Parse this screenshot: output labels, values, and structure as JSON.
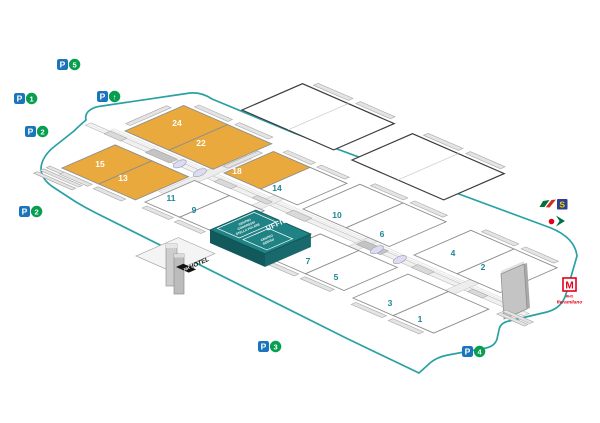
{
  "colors": {
    "boundary": "#2aa0a5",
    "hall_highlight": "#e9a93c",
    "hall_fill": "#ffffff",
    "hall_stroke": "#8f8f8f",
    "outlined_hall_stroke": "#3c3c3c",
    "hall_number": "#1e8795",
    "hall_number_highlight": "#ffffff",
    "offices_fill": "#1f8285",
    "offices_side_dark": "#11595b",
    "offices_side_mid": "#19696c",
    "parking_blue": "#1b75bc",
    "parking_green": "#069e4f",
    "metro_red": "#e2001a",
    "s_line_blue": "#2a3f90",
    "s_line_yellow": "#ffd200",
    "fs_green": "#00703c",
    "fs_red": "#d52b1e",
    "trenord_green": "#00704a",
    "ramp_fill": "#e4e4e4",
    "axis_fill": "#f0f0f0"
  },
  "halls": {
    "pairs": [
      {
        "id": "24-22",
        "labels": [
          "24",
          "22"
        ],
        "highlighted": [
          true,
          true
        ]
      },
      {
        "id": "18-14",
        "labels": [
          "18",
          "14"
        ],
        "highlighted": [
          true,
          false
        ]
      },
      {
        "id": "10-6",
        "labels": [
          "10",
          "6"
        ],
        "highlighted": [
          false,
          false
        ]
      },
      {
        "id": "4-2",
        "labels": [
          "4",
          "2"
        ],
        "highlighted": [
          false,
          false
        ]
      },
      {
        "id": "15-13",
        "labels": [
          "15",
          "13"
        ],
        "highlighted": [
          true,
          true
        ]
      },
      {
        "id": "11-9",
        "labels": [
          "11",
          "9"
        ],
        "highlighted": [
          false,
          false
        ]
      },
      {
        "id": "7-5",
        "labels": [
          "7",
          "5"
        ],
        "highlighted": [
          false,
          false
        ]
      },
      {
        "id": "3-1",
        "labels": [
          "3",
          "1"
        ],
        "highlighted": [
          false,
          false
        ]
      }
    ],
    "outlined_unlabeled_count": 2
  },
  "offices": {
    "title": "UFFICI",
    "congress_center": [
      "CENTRO",
      "CONGRESSI",
      "STELLA POLARE"
    ],
    "services_center": [
      "CENTRO",
      "SERVIZI"
    ]
  },
  "hotel": {
    "label": "HOTEL",
    "brand": "NH"
  },
  "metro": {
    "symbol": "M",
    "station_line1": "RHO",
    "station_line2": "fieramilano"
  },
  "rail": {
    "s_badge": "S"
  },
  "parking": [
    {
      "id": "p5",
      "letter": "P",
      "value": "5"
    },
    {
      "id": "p1",
      "letter": "P",
      "value": "1"
    },
    {
      "id": "p-multi",
      "letter": "P",
      "value": "↑"
    },
    {
      "id": "p2-west",
      "letter": "P",
      "value": "2"
    },
    {
      "id": "p2-south",
      "letter": "P",
      "value": "2"
    },
    {
      "id": "p3",
      "letter": "P",
      "value": "3"
    },
    {
      "id": "p4",
      "letter": "P",
      "value": "4"
    }
  ]
}
